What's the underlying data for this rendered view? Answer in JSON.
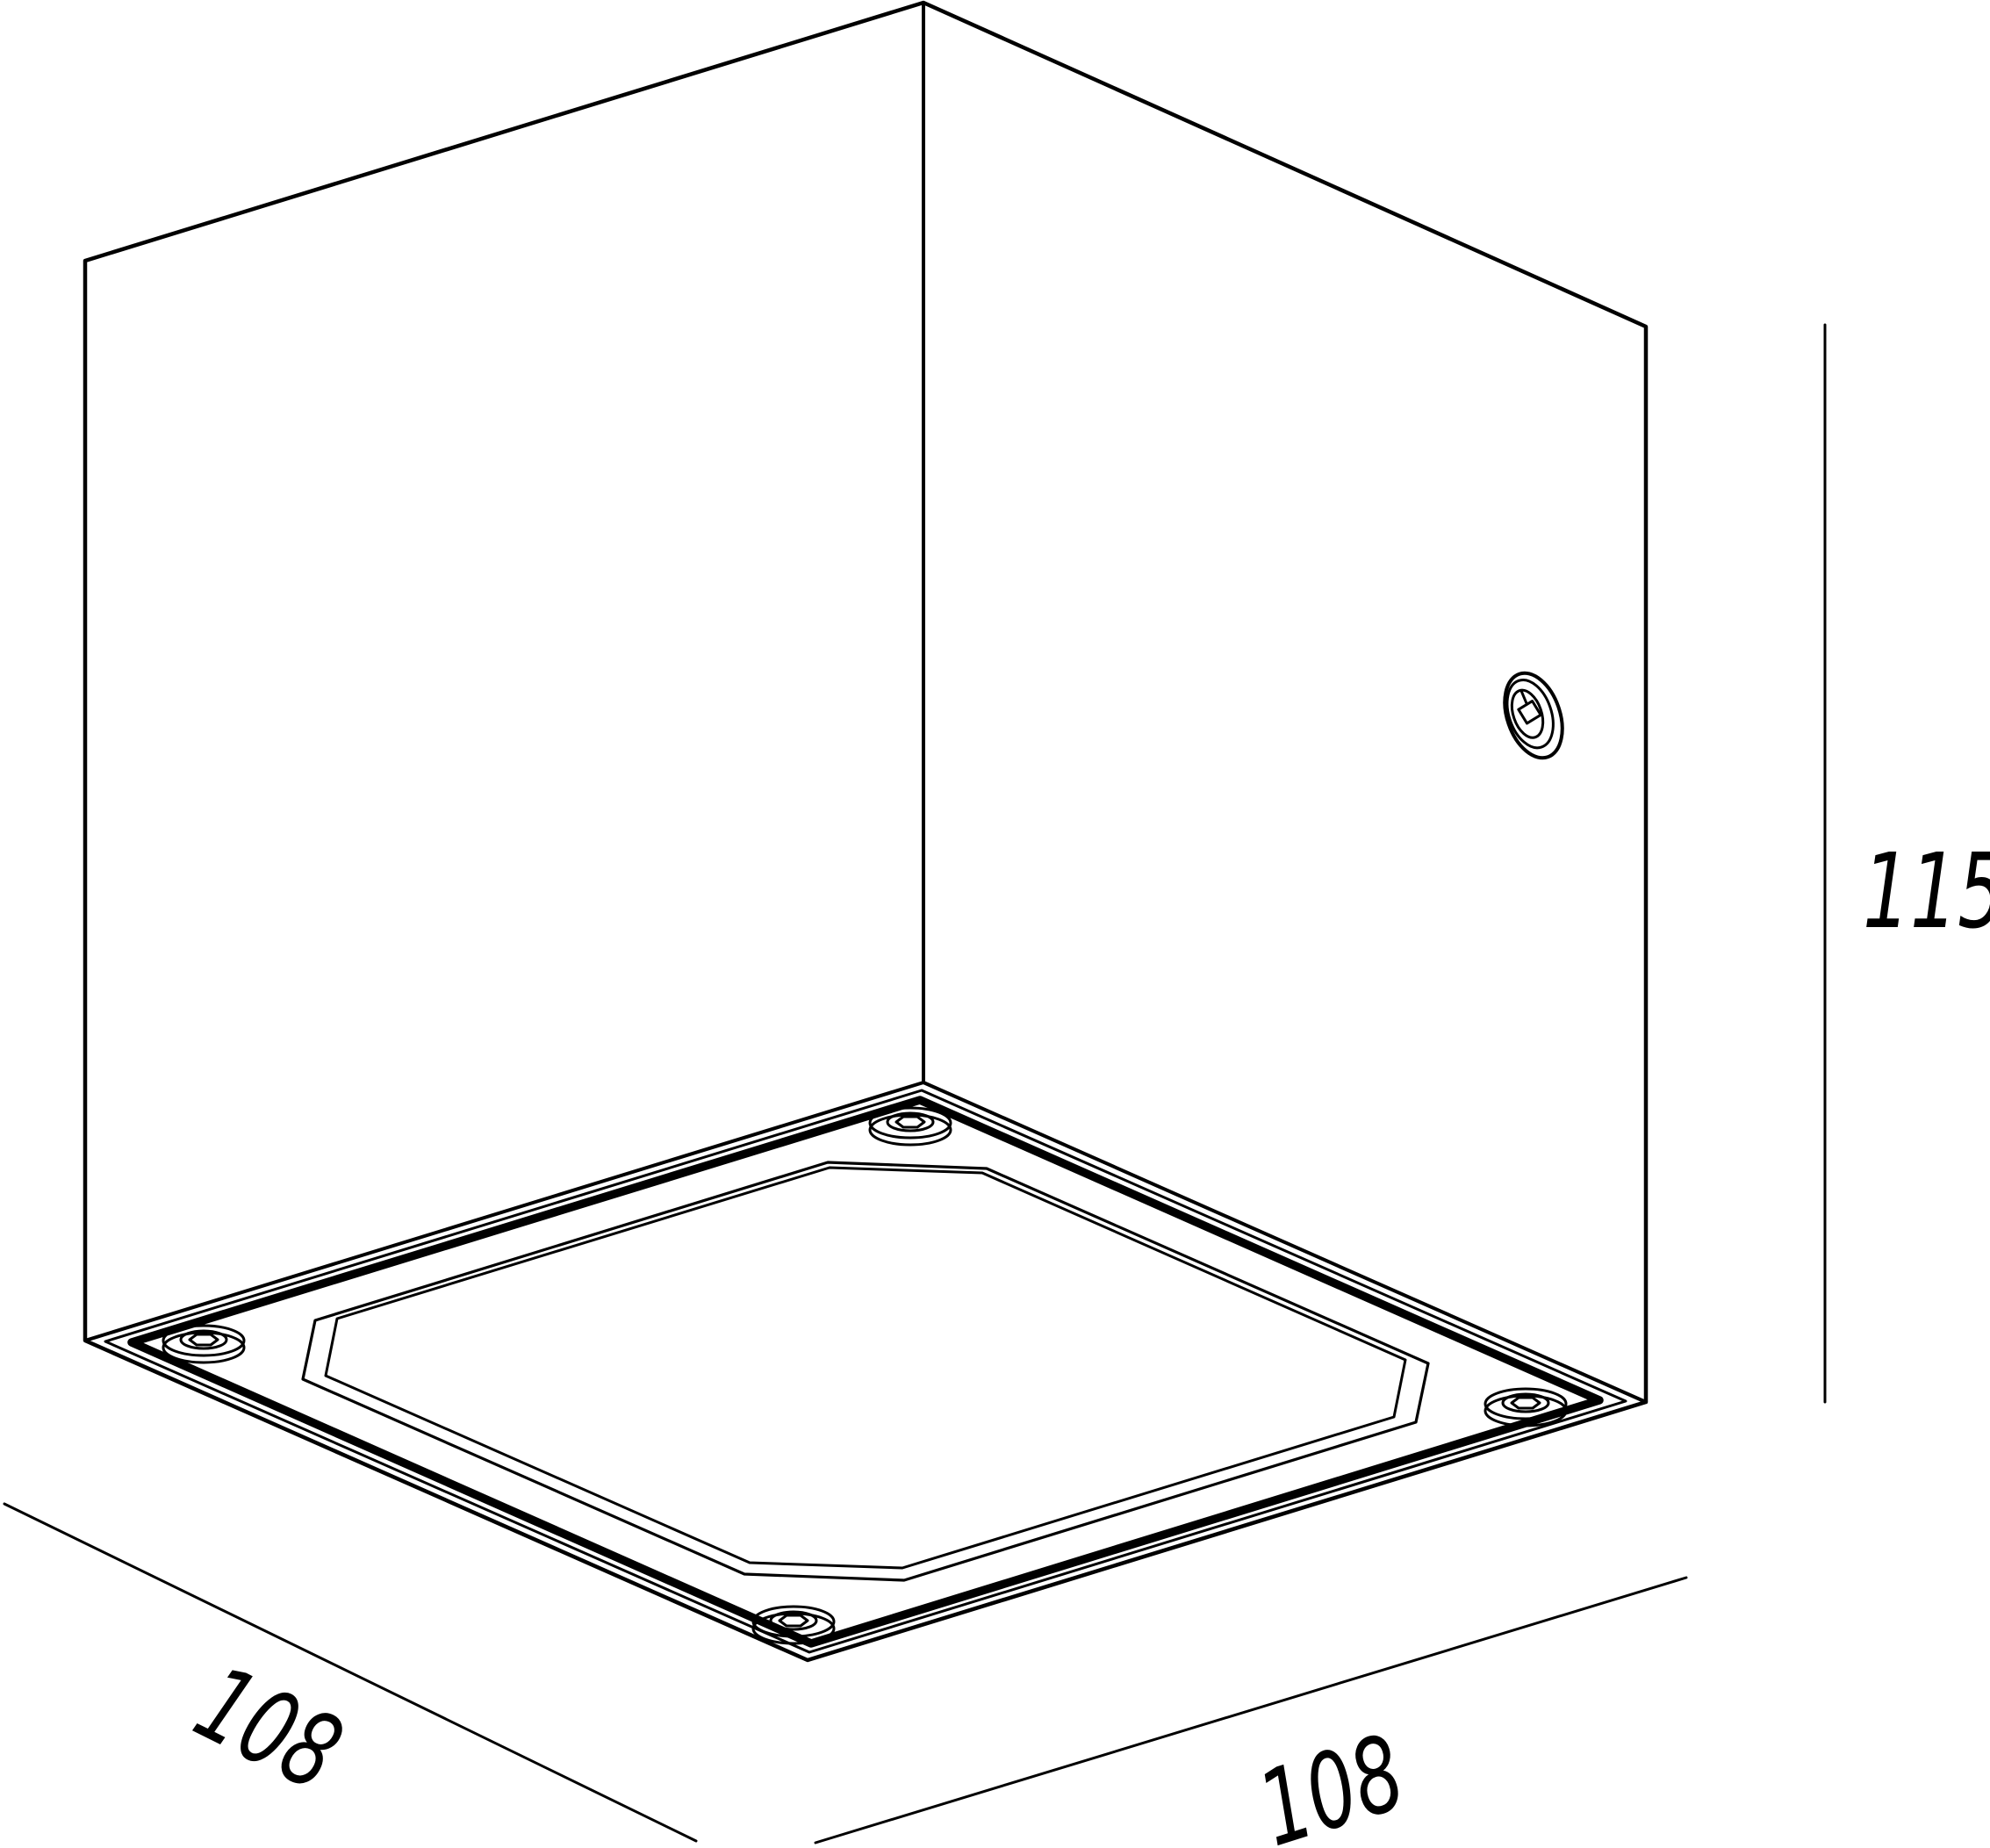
{
  "figure": {
    "dimension_labels": {
      "depth_left": "108",
      "width_right": "108",
      "height": "115"
    }
  },
  "colors": {
    "line": "#000000",
    "background": "#ffffff"
  }
}
